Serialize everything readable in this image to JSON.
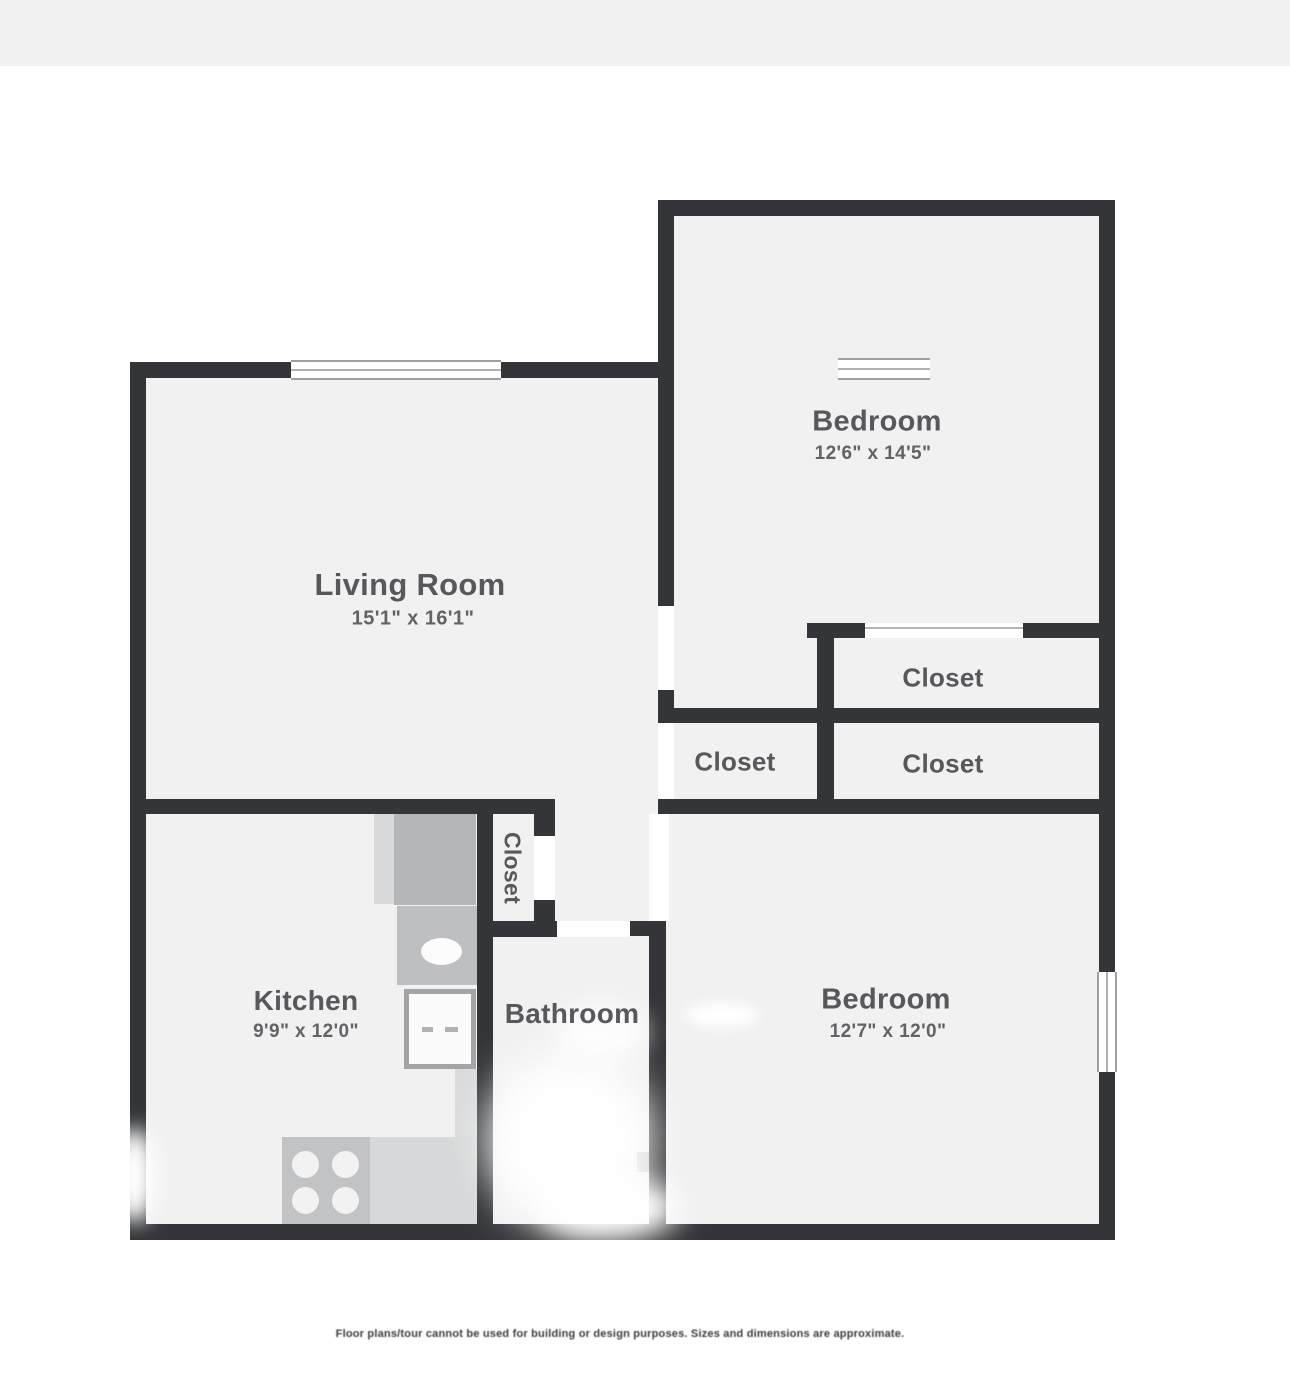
{
  "colors": {
    "wall": "#333538",
    "floor": "#f1f1f2",
    "label": "#57585b",
    "dims": "#626366",
    "fixture": "#bfc0c2",
    "page_background": "#ffffff",
    "top_band": "#f1f1f2"
  },
  "floorplan": {
    "rooms": {
      "living": {
        "label": "Living Room",
        "dims": "15'1\" x 16'1\""
      },
      "bedroom1": {
        "label": "Bedroom",
        "dims": "12'6\" x 14'5\""
      },
      "closet_top": {
        "label": "Closet"
      },
      "closet_left": {
        "label": "Closet"
      },
      "closet_right": {
        "label": "Closet"
      },
      "closet_hall": {
        "label": "Closet"
      },
      "kitchen": {
        "label": "Kitchen",
        "dims": "9'9\" x 12'0\""
      },
      "bathroom": {
        "label": "Bathroom"
      },
      "bedroom2": {
        "label": "Bedroom",
        "dims": "12'7\" x 12'0\""
      }
    },
    "disclaimer": "Floor plans/tour cannot be used for building or design purposes. Sizes and dimensions are approximate."
  }
}
